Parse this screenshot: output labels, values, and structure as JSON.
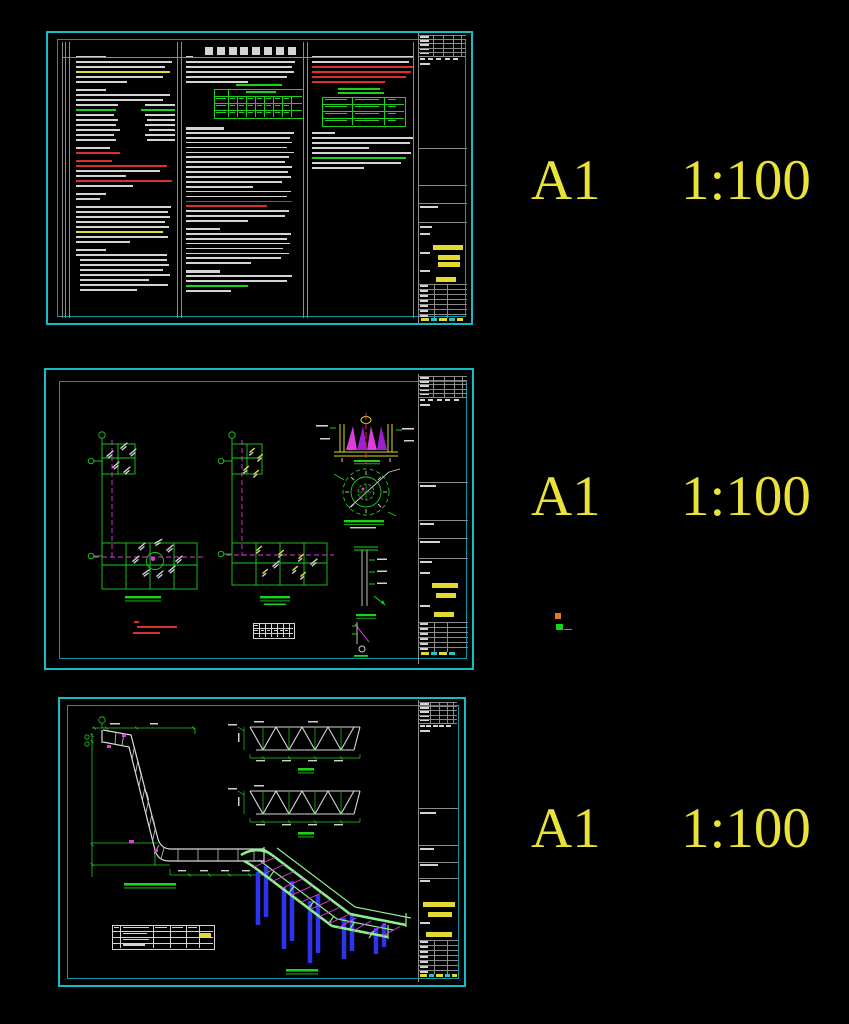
{
  "labels": {
    "rows": [
      {
        "size": "A1",
        "scale": "1:100"
      },
      {
        "size": "A1",
        "scale": "1:100"
      },
      {
        "size": "A1",
        "scale": "1:100"
      }
    ]
  },
  "colors": {
    "w": "#d4d4d4",
    "r": "#d83030",
    "g": "#1ad21a",
    "y": "#e2da30",
    "c": "#20c8c8",
    "m": "#de3cde",
    "o": "#e07820",
    "gl": "#8a8a8a",
    "b": "#2c34f0",
    "accent_border": "#14bcc8",
    "label_yellow": "#e8e23a"
  },
  "note_columns": [
    {
      "x": 76,
      "y": 56,
      "w": 99,
      "pitch": 5.0,
      "lh": 1.8,
      "lines": [
        {
          "w": 0.3,
          "h": 2.4
        },
        {
          "w": 0.97
        },
        {
          "w": 0.9
        },
        {
          "w": 0.95,
          "c": "y"
        },
        {
          "w": 0.88
        },
        {
          "w": 0.52
        },
        {
          "w": 0.3,
          "h": 2.4,
          "g": 3
        },
        {
          "w": 0.95
        },
        {
          "w": 0.88
        },
        {
          "w": 0.42,
          "r": 0.3
        },
        {
          "w": 0.4,
          "c": "g",
          "r": 0.34,
          "rc": "g"
        },
        {
          "w": 0.38,
          "r": 0.3
        },
        {
          "w": 0.42,
          "r": 0.28
        },
        {
          "w": 0.4,
          "r": 0.3
        },
        {
          "w": 0.44,
          "r": 0.26
        },
        {
          "w": 0.38,
          "r": 0.3
        },
        {
          "w": 0.4,
          "r": 0.28
        },
        {
          "w": 0.34,
          "g": 3
        },
        {
          "w": 0.44,
          "c": "r"
        },
        {
          "w": 0.36,
          "c": "r",
          "g": 3,
          "h": 2.2
        },
        {
          "w": 0.92,
          "c": "r"
        },
        {
          "w": 0.85
        },
        {
          "w": 0.5
        },
        {
          "w": 0.97,
          "c": "r"
        },
        {
          "w": 0.58
        },
        {
          "w": 0.3,
          "h": 2.4,
          "g": 3
        },
        {
          "w": 0.24
        },
        {
          "w": 0.96,
          "g": 3
        },
        {
          "w": 0.93
        },
        {
          "w": 0.95
        },
        {
          "w": 0.9
        },
        {
          "w": 0.94
        },
        {
          "w": 0.88,
          "c": "y"
        },
        {
          "w": 0.93
        },
        {
          "w": 0.55
        },
        {
          "w": 0.3,
          "h": 2.4,
          "g": 3
        },
        {
          "w": 0.92
        },
        {
          "w": 0.88,
          "ind": 4
        },
        {
          "w": 0.9,
          "ind": 4
        },
        {
          "w": 0.84,
          "ind": 4
        },
        {
          "w": 0.91,
          "ind": 4
        },
        {
          "w": 0.7,
          "ind": 4
        },
        {
          "w": 0.89,
          "ind": 4
        },
        {
          "w": 0.58,
          "ind": 4
        }
      ]
    },
    {
      "x": 186,
      "y": 56,
      "w": 112,
      "pitch": 5.0,
      "lh": 1.8,
      "lines": [
        {
          "w": 0.06,
          "h": 2.2
        },
        {
          "w": 0.97
        },
        {
          "w": 0.95
        },
        {
          "w": 0.96
        },
        {
          "w": 0.9
        },
        {
          "w": 0.55
        }
      ]
    },
    {
      "x": 186,
      "y": 127,
      "w": 112,
      "pitch": 4.9,
      "lh": 1.8,
      "lines": [
        {
          "w": 0.34,
          "h": 2.6
        },
        {
          "w": 0.96
        },
        {
          "w": 0.93
        },
        {
          "w": 0.95
        },
        {
          "w": 0.9
        },
        {
          "w": 0.96
        },
        {
          "w": 0.92
        },
        {
          "w": 0.88
        },
        {
          "w": 0.95
        },
        {
          "w": 0.91
        },
        {
          "w": 0.94
        },
        {
          "w": 0.86
        },
        {
          "w": 0.6
        },
        {
          "w": 0.94
        },
        {
          "w": 0.9
        },
        {
          "w": 0.95,
          "c": "r"
        },
        {
          "w": 0.72,
          "c": "r"
        },
        {
          "w": 0.92
        },
        {
          "w": 0.88
        },
        {
          "w": 0.55
        },
        {
          "w": 0.3,
          "h": 2.4,
          "g": 3
        },
        {
          "w": 0.94
        },
        {
          "w": 0.9
        },
        {
          "w": 0.93
        },
        {
          "w": 0.87
        },
        {
          "w": 0.92
        },
        {
          "w": 0.85
        },
        {
          "w": 0.58
        },
        {
          "w": 0.3,
          "h": 2.4,
          "g": 3
        },
        {
          "w": 0.95
        },
        {
          "w": 0.9
        },
        {
          "w": 0.55,
          "c": "g"
        },
        {
          "w": 0.4
        }
      ]
    },
    {
      "x": 312,
      "y": 56,
      "w": 104,
      "pitch": 5.0,
      "lh": 1.8,
      "lines": [
        {
          "w": 0.97
        },
        {
          "w": 0.93
        },
        {
          "w": 0.97,
          "c": "r"
        },
        {
          "w": 0.95,
          "c": "r"
        },
        {
          "w": 0.9,
          "c": "r"
        },
        {
          "w": 0.7,
          "c": "r"
        },
        {
          "w": 0.4,
          "c": "g",
          "ind": 26,
          "g": 2
        }
      ]
    },
    {
      "x": 312,
      "y": 132,
      "w": 104,
      "pitch": 5.0,
      "lh": 1.8,
      "lines": [
        {
          "w": 0.22,
          "h": 2.4
        },
        {
          "w": 0.97
        },
        {
          "w": 0.94
        },
        {
          "w": 0.55
        },
        {
          "w": 0.95
        },
        {
          "w": 0.9,
          "c": "g"
        },
        {
          "w": 0.86
        },
        {
          "w": 0.5
        }
      ]
    }
  ],
  "prims": [
    [
      205,
      47,
      8,
      8,
      "w"
    ],
    [
      217,
      47,
      8,
      8,
      "w"
    ],
    [
      229,
      47,
      8,
      8,
      "w"
    ],
    [
      240,
      47,
      8,
      8,
      "w"
    ],
    [
      252,
      47,
      8,
      8,
      "w"
    ],
    [
      264,
      47,
      8,
      8,
      "w"
    ],
    [
      276,
      47,
      8,
      8,
      "w"
    ],
    [
      288,
      47,
      8,
      8,
      "w"
    ],
    [
      62,
      42,
      0.8,
      276,
      "gl"
    ],
    [
      65,
      42,
      0.8,
      276,
      "gl"
    ],
    [
      68.5,
      42,
      0.8,
      276,
      "gl"
    ],
    [
      177,
      42,
      0.8,
      276,
      "gl"
    ],
    [
      181,
      42,
      0.8,
      276,
      "gl"
    ],
    [
      303,
      42,
      0.8,
      276,
      "gl"
    ],
    [
      307,
      42,
      0.8,
      276,
      "gl"
    ],
    [
      413,
      42,
      0.8,
      276,
      "gl"
    ],
    [
      62,
      57,
      352,
      0.8,
      "gl"
    ],
    [
      214,
      89,
      88,
      28,
      "g_o"
    ],
    [
      214,
      96,
      88,
      0.7,
      "g"
    ],
    [
      214,
      103,
      88,
      0.7,
      "g"
    ],
    [
      214,
      110,
      88,
      0.7,
      "g"
    ],
    [
      228,
      89,
      0.7,
      28,
      "g"
    ],
    [
      237,
      96,
      0.7,
      21,
      "g"
    ],
    [
      246,
      96,
      0.7,
      21,
      "g"
    ],
    [
      255,
      96,
      0.7,
      21,
      "g"
    ],
    [
      264,
      96,
      0.7,
      21,
      "g"
    ],
    [
      273,
      96,
      0.7,
      21,
      "g"
    ],
    [
      282,
      96,
      0.7,
      21,
      "g"
    ],
    [
      291,
      96,
      0.7,
      21,
      "g"
    ],
    [
      236,
      84,
      46,
      2.2,
      "g"
    ],
    [
      246,
      90.5,
      30,
      2,
      "g"
    ],
    [
      216,
      97.5,
      10,
      1.7,
      "g"
    ],
    [
      230,
      97.5,
      5,
      1.7,
      "g"
    ],
    [
      239,
      97.5,
      5,
      1.7,
      "g"
    ],
    [
      248,
      97.5,
      5,
      1.7,
      "g"
    ],
    [
      257,
      97.5,
      5,
      1.7,
      "g"
    ],
    [
      266,
      97.5,
      5,
      1.7,
      "g"
    ],
    [
      275,
      97.5,
      5,
      1.7,
      "g"
    ],
    [
      284,
      97.5,
      5,
      1.7,
      "g"
    ],
    [
      216,
      104.5,
      10,
      1.7,
      "g"
    ],
    [
      230,
      104.5,
      5,
      1.7,
      "g"
    ],
    [
      239,
      104.5,
      5,
      1.7,
      "g"
    ],
    [
      248,
      104.5,
      5,
      1.7,
      "g"
    ],
    [
      257,
      104.5,
      5,
      1.7,
      "g"
    ],
    [
      266,
      104.5,
      5,
      1.7,
      "g"
    ],
    [
      275,
      104.5,
      5,
      1.7,
      "g"
    ],
    [
      284,
      104.5,
      5,
      1.7,
      "g"
    ],
    [
      216,
      111.5,
      10,
      1.7,
      "g"
    ],
    [
      230,
      111.5,
      5,
      1.7,
      "g"
    ],
    [
      239,
      111.5,
      5,
      1.7,
      "g"
    ],
    [
      248,
      111.5,
      5,
      1.7,
      "g"
    ],
    [
      257,
      111.5,
      5,
      1.7,
      "g"
    ],
    [
      266,
      111.5,
      5,
      1.7,
      "g"
    ],
    [
      275,
      111.5,
      5,
      1.7,
      "g"
    ],
    [
      284,
      111.5,
      5,
      1.7,
      "g"
    ],
    [
      322,
      97,
      82,
      28,
      "g_o"
    ],
    [
      322,
      104,
      82,
      0.7,
      "g"
    ],
    [
      322,
      111,
      82,
      0.7,
      "g"
    ],
    [
      322,
      118,
      82,
      0.7,
      "g"
    ],
    [
      352,
      97,
      0.7,
      28,
      "g"
    ],
    [
      384,
      97,
      0.7,
      28,
      "g"
    ],
    [
      338,
      92,
      46,
      2.2,
      "g"
    ],
    [
      325,
      98.5,
      22,
      1.7,
      "g"
    ],
    [
      355,
      98.5,
      24,
      1.7,
      "g"
    ],
    [
      388,
      98.5,
      8,
      1.7,
      "g"
    ],
    [
      325,
      105.5,
      22,
      1.7,
      "g"
    ],
    [
      355,
      105.5,
      24,
      1.7,
      "g"
    ],
    [
      388,
      105.5,
      8,
      1.7,
      "g"
    ],
    [
      325,
      112.5,
      22,
      1.7,
      "g"
    ],
    [
      355,
      112.5,
      24,
      1.7,
      "g"
    ],
    [
      388,
      112.5,
      8,
      1.7,
      "g"
    ],
    [
      325,
      119.5,
      22,
      1.7,
      "g"
    ],
    [
      355,
      119.5,
      24,
      1.7,
      "g"
    ],
    [
      388,
      119.5,
      8,
      1.7,
      "g"
    ],
    [
      134,
      621,
      5,
      2,
      "r"
    ],
    [
      137,
      626,
      40,
      2,
      "r"
    ],
    [
      133,
      632,
      27,
      2,
      "r"
    ],
    [
      253,
      623,
      40,
      14,
      "w_o"
    ],
    [
      253,
      628,
      40,
      0.6,
      "w"
    ],
    [
      253,
      633,
      40,
      0.6,
      "w"
    ],
    [
      259,
      623,
      0.6,
      14,
      "w"
    ],
    [
      265,
      623,
      0.6,
      14,
      "w"
    ],
    [
      271,
      623,
      0.6,
      14,
      "w"
    ],
    [
      277,
      623,
      0.6,
      14,
      "w"
    ],
    [
      283,
      623,
      0.6,
      14,
      "w"
    ],
    [
      289,
      623,
      0.6,
      14,
      "w"
    ],
    [
      254,
      624.5,
      4,
      1.4,
      "w"
    ],
    [
      254,
      629.5,
      4,
      1.4,
      "w"
    ],
    [
      261,
      629.5,
      3,
      1.4,
      "w"
    ],
    [
      267,
      629.5,
      3,
      1.4,
      "w"
    ],
    [
      274,
      629.5,
      3,
      1.4,
      "w"
    ],
    [
      280,
      629.5,
      3,
      1.4,
      "w"
    ],
    [
      285,
      629.5,
      3,
      1.4,
      "w"
    ],
    [
      555,
      613,
      6,
      6,
      "o"
    ],
    [
      556,
      624,
      7,
      6,
      "g"
    ],
    [
      564,
      629,
      8,
      1,
      "g"
    ],
    [
      112,
      925,
      101,
      23,
      "w_o"
    ],
    [
      112,
      931,
      101,
      0.6,
      "w"
    ],
    [
      112,
      937,
      101,
      0.6,
      "w"
    ],
    [
      112,
      943,
      101,
      0.6,
      "w"
    ],
    [
      120,
      925,
      0.6,
      23,
      "w"
    ],
    [
      153,
      925,
      0.6,
      23,
      "w"
    ],
    [
      170,
      925,
      0.6,
      23,
      "w"
    ],
    [
      186,
      925,
      0.6,
      23,
      "w"
    ],
    [
      199,
      925,
      0.6,
      23,
      "w"
    ],
    [
      200,
      933,
      11,
      3.5,
      "y"
    ],
    [
      114,
      926.5,
      5,
      1.5,
      "w"
    ],
    [
      123,
      926.5,
      26,
      1.5,
      "w"
    ],
    [
      155,
      926.5,
      12,
      1.5,
      "w"
    ],
    [
      172,
      926.5,
      11,
      1.5,
      "w"
    ],
    [
      188,
      926.5,
      9,
      1.5,
      "w"
    ],
    [
      123,
      932.5,
      24,
      1.5,
      "w"
    ],
    [
      123,
      938.5,
      26,
      1.5,
      "w"
    ],
    [
      123,
      944,
      22,
      1.5,
      "w"
    ]
  ],
  "titleblocks": [
    {
      "x": 418,
      "w": 49,
      "y0": 33,
      "y1": 324,
      "div": [
        148,
        185,
        203,
        222
      ],
      "labels": [
        [
          420,
          206,
          18
        ],
        [
          420,
          226,
          12
        ],
        [
          420,
          233,
          10
        ],
        [
          420,
          252,
          10
        ],
        [
          420,
          270,
          10
        ]
      ],
      "bars": [
        [
          433,
          245,
          30
        ],
        [
          438,
          255,
          22
        ],
        [
          438,
          262,
          22
        ],
        [
          436,
          277,
          20
        ]
      ],
      "grid": 284,
      "cells": 318,
      "cellbars": [
        [
          421,
          318,
          8,
          "y"
        ],
        [
          431,
          318,
          6,
          "c"
        ],
        [
          439,
          318,
          8,
          "y"
        ],
        [
          449,
          318,
          6,
          "c"
        ],
        [
          457,
          318,
          6,
          "y"
        ]
      ]
    },
    {
      "x": 418,
      "w": 50,
      "y0": 374,
      "y1": 664,
      "div": [
        482,
        520,
        538,
        558
      ],
      "labels": [
        [
          420,
          485,
          16
        ],
        [
          420,
          523,
          14
        ],
        [
          420,
          541,
          20
        ],
        [
          420,
          561,
          12
        ],
        [
          420,
          572,
          10
        ],
        [
          420,
          605,
          10
        ]
      ],
      "bars": [
        [
          432,
          583,
          26
        ],
        [
          436,
          593,
          20
        ],
        [
          434,
          612,
          20
        ]
      ],
      "grid": 622,
      "cells": 652,
      "cellbars": [
        [
          421,
          652,
          8,
          "y"
        ],
        [
          431,
          652,
          6,
          "c"
        ],
        [
          439,
          652,
          8,
          "y"
        ],
        [
          449,
          652,
          6,
          "c"
        ]
      ]
    },
    {
      "x": 418,
      "w": 40,
      "y0": 700,
      "y1": 982,
      "div": [
        808,
        845,
        862,
        878
      ],
      "labels": [
        [
          420,
          812,
          16
        ],
        [
          420,
          848,
          14
        ],
        [
          420,
          864,
          18
        ],
        [
          420,
          880,
          10
        ],
        [
          420,
          922,
          10
        ]
      ],
      "bars": [
        [
          423,
          902,
          32
        ],
        [
          428,
          912,
          24
        ],
        [
          426,
          932,
          26
        ]
      ],
      "grid": 940,
      "cells": 974,
      "cellbars": [
        [
          420,
          974,
          7,
          "y"
        ],
        [
          429,
          974,
          5,
          "c"
        ],
        [
          436,
          974,
          7,
          "y"
        ],
        [
          445,
          974,
          5,
          "c"
        ],
        [
          452,
          974,
          5,
          "y"
        ]
      ]
    }
  ]
}
